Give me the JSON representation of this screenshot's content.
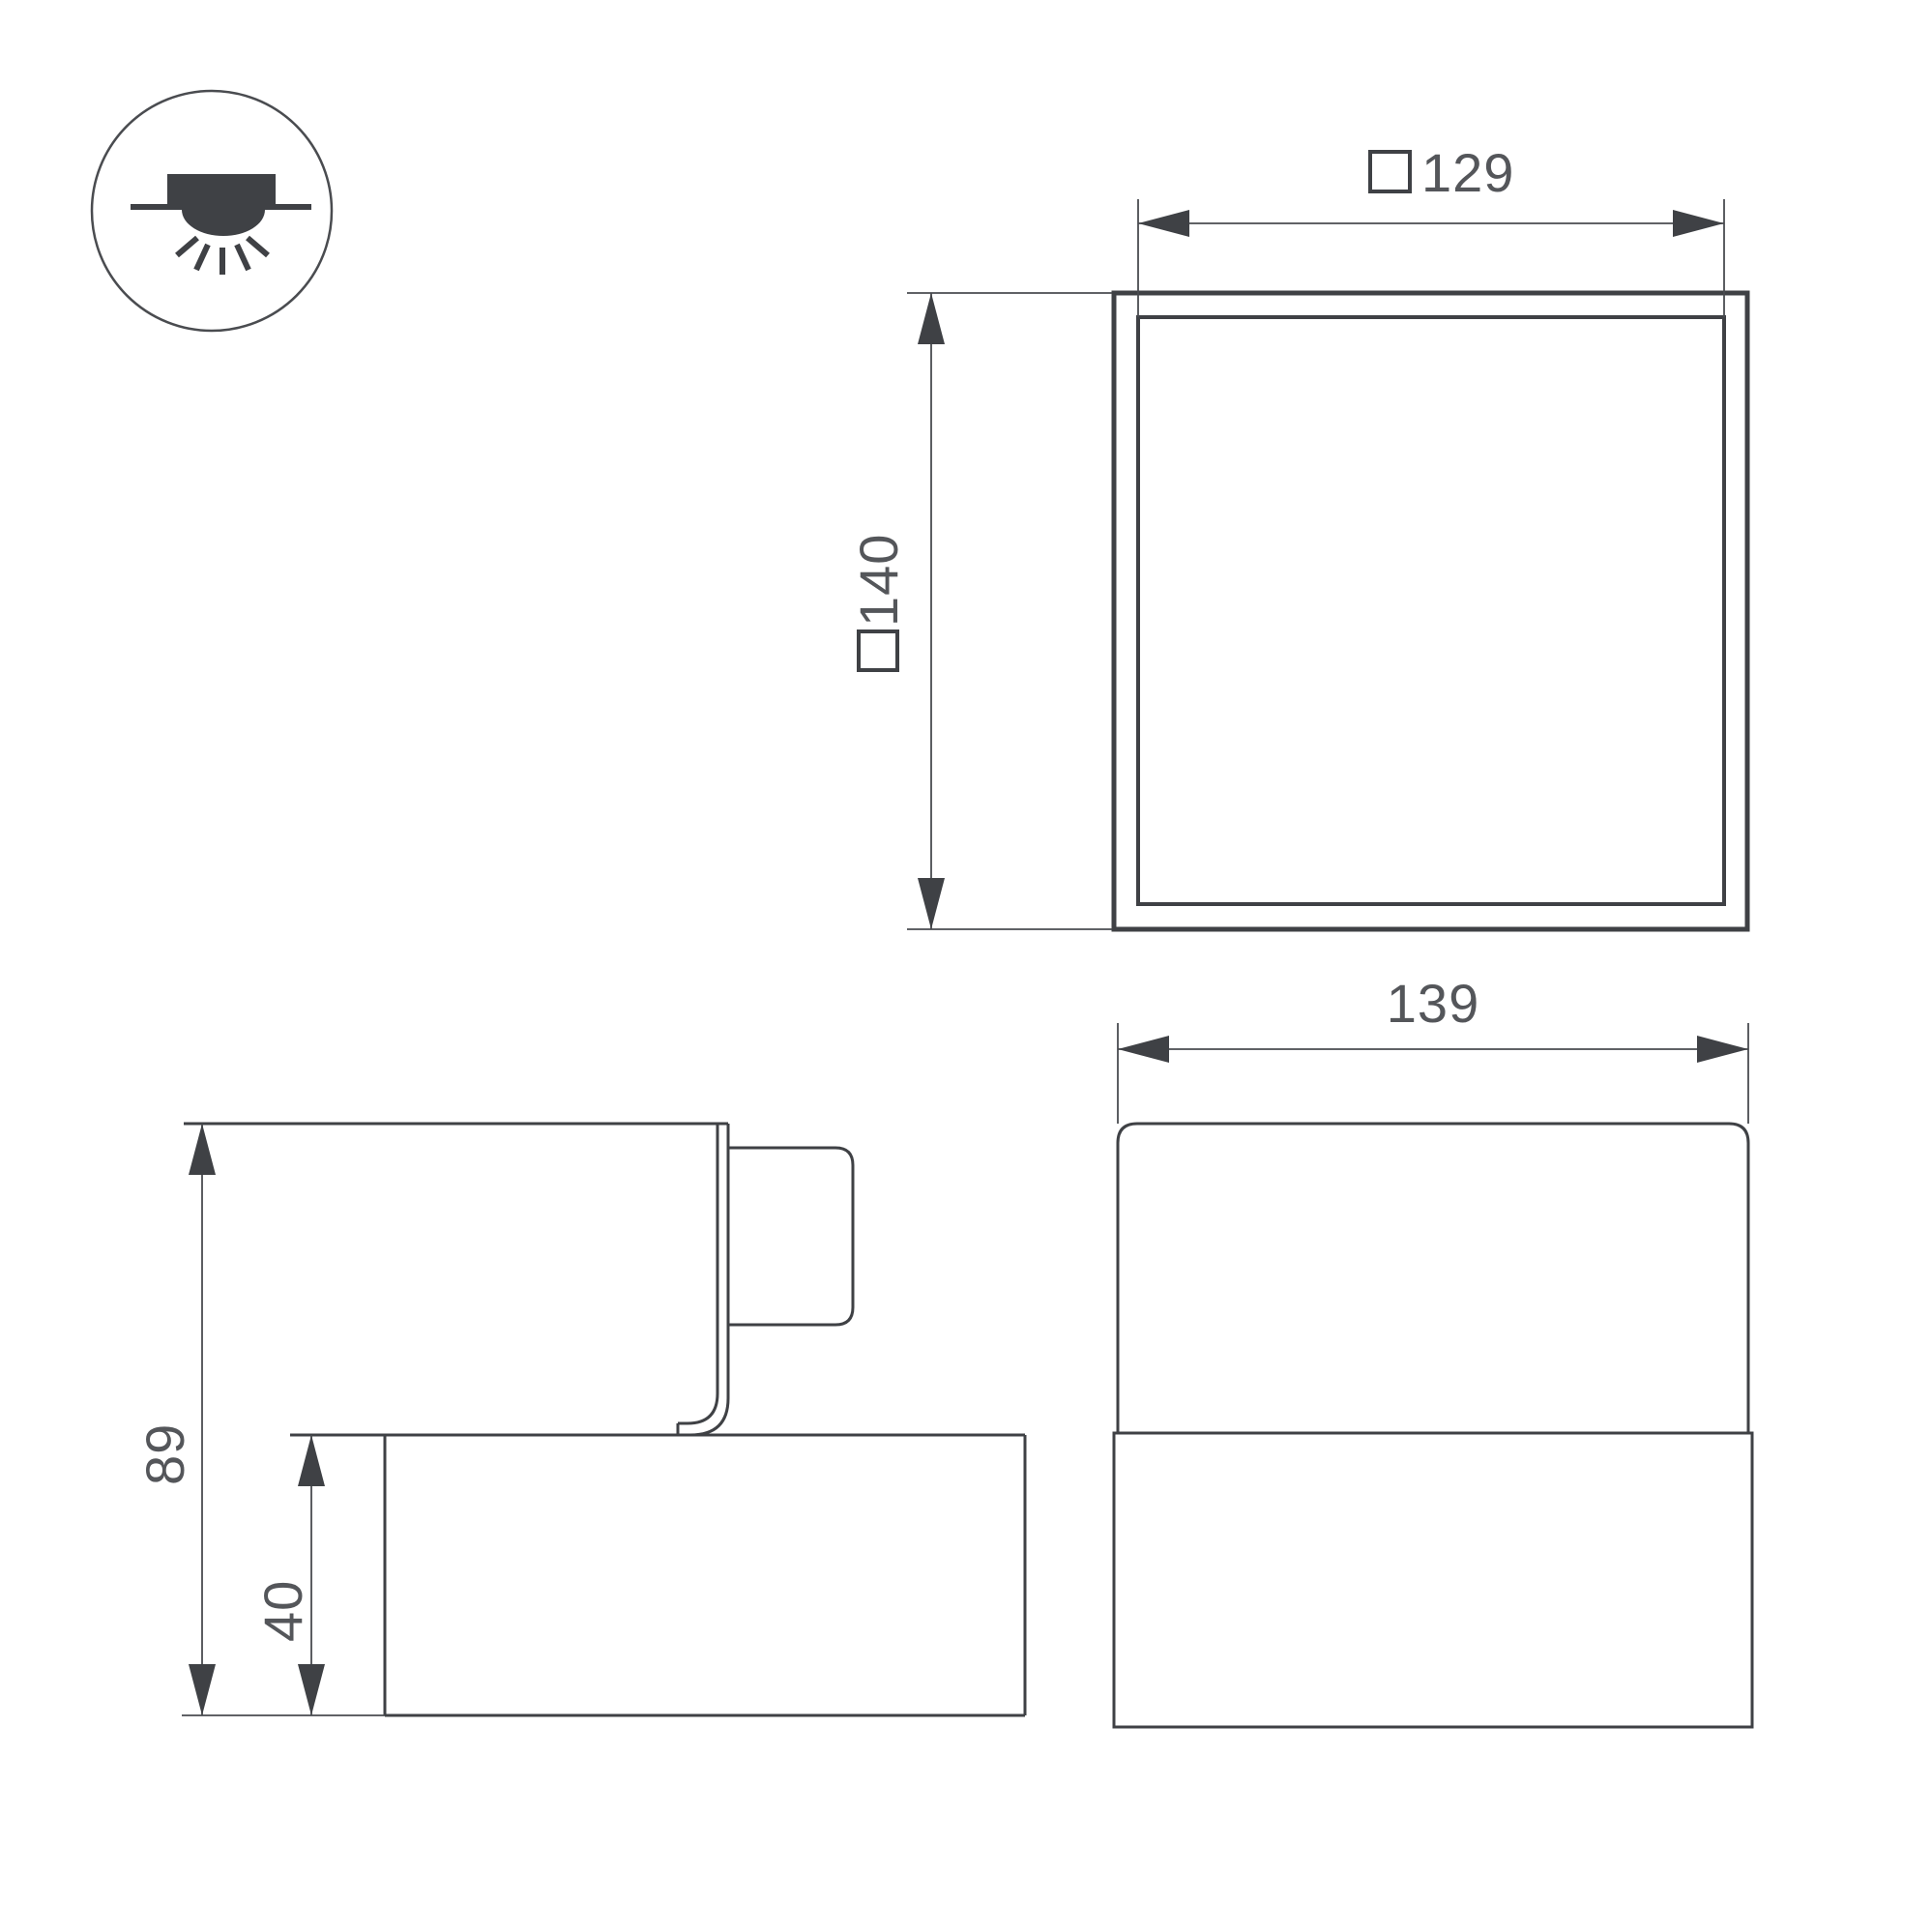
{
  "colors": {
    "line": "#3f4145",
    "dimension_text": "#54565a",
    "background": "#ffffff"
  },
  "icon": {
    "name": "recessed-ceiling-light-icon"
  },
  "views": {
    "top": {
      "inner_dimension": {
        "symbol": "□",
        "value": "129"
      },
      "outer_dimension": {
        "symbol": "□",
        "value": "140"
      }
    },
    "side": {
      "overall_height": {
        "value": "89"
      },
      "base_height": {
        "value": "40"
      }
    },
    "front": {
      "overall_width": {
        "value": "139"
      }
    }
  }
}
